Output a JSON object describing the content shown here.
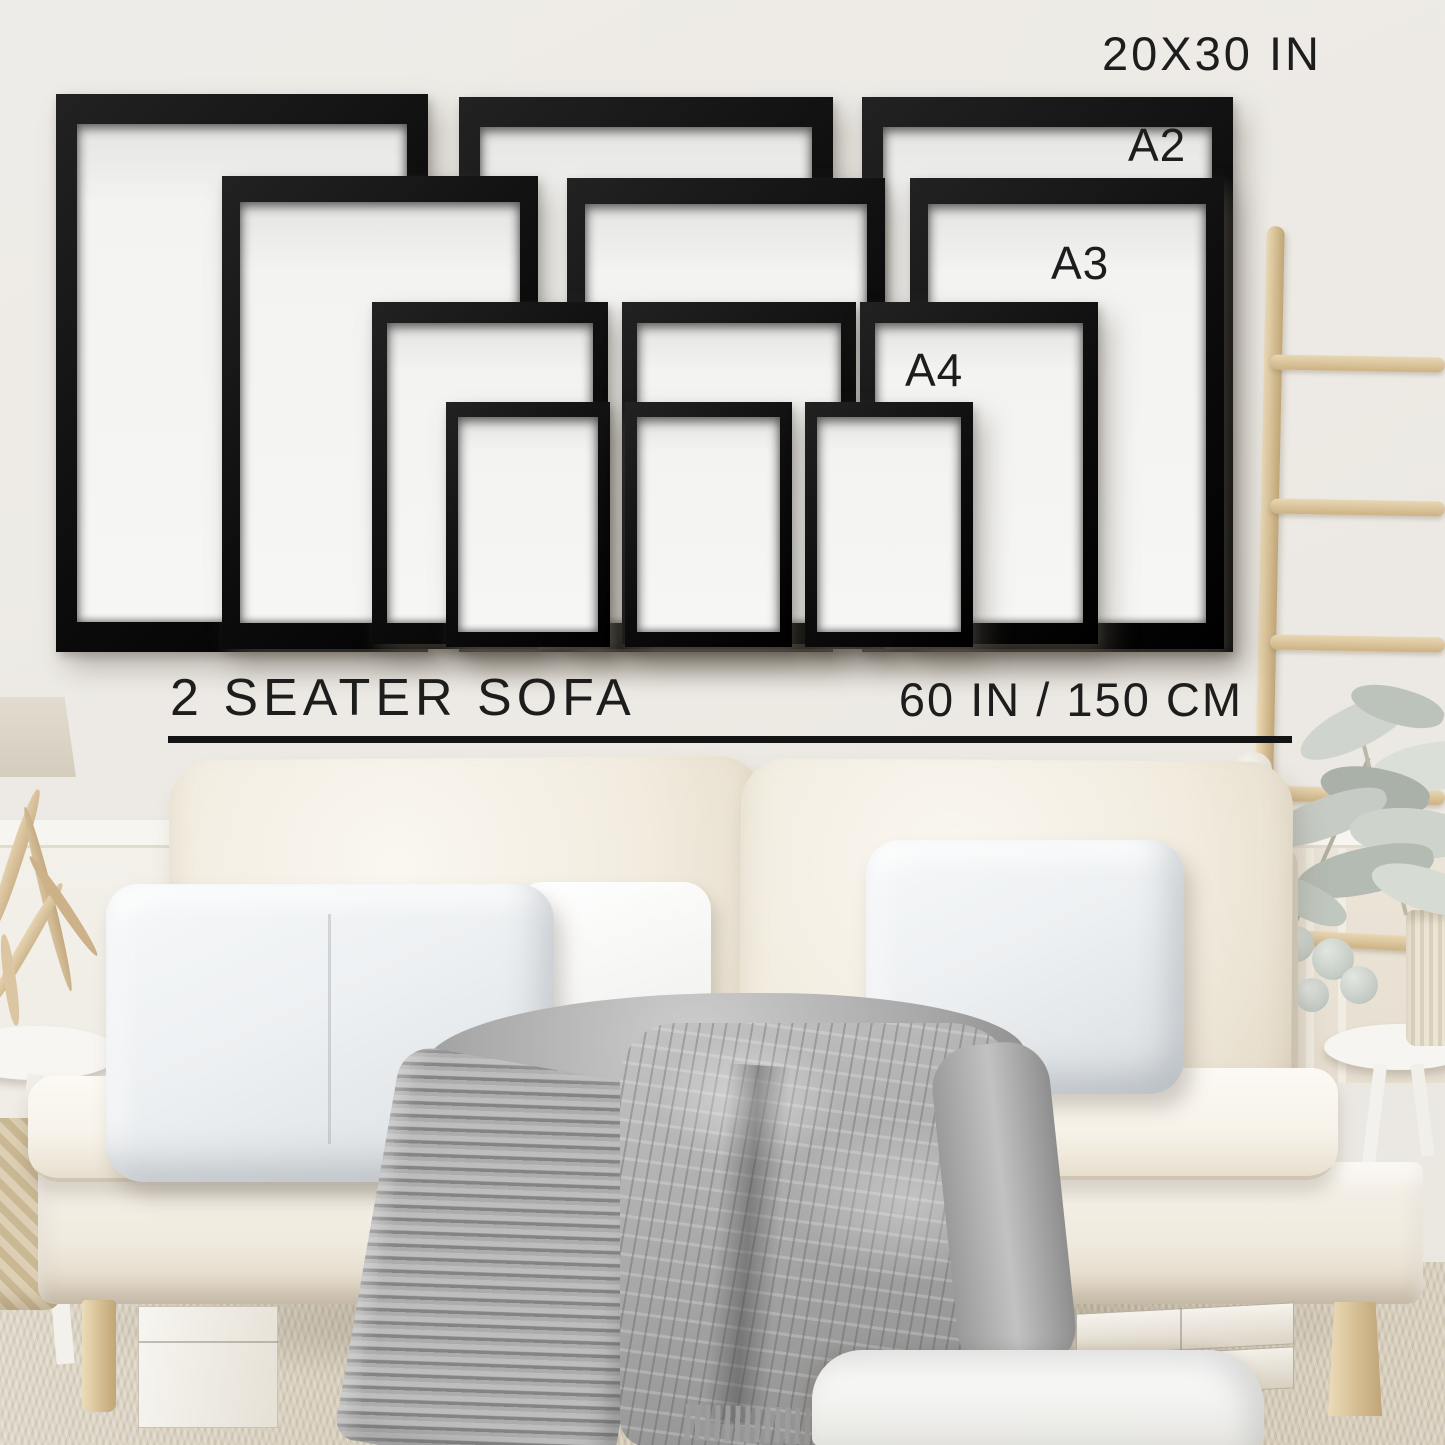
{
  "page_type": "poster-frame-size-guide-mockup",
  "size_chart": {
    "labels": {
      "largest": "20X30 IN",
      "a2": "A2",
      "a3": "A3",
      "a4": "A4"
    },
    "frame_rows": [
      {
        "size": "20X30 IN",
        "count": 3
      },
      {
        "size": "A2",
        "count": 3
      },
      {
        "size": "A3",
        "count": 3
      },
      {
        "size": "A4",
        "count": 3
      }
    ],
    "sofa_label": "2 SEATER SOFA",
    "sofa_width_label": "60 IN / 150 CM"
  },
  "colors": {
    "frame": "#141414",
    "text": "#1d1d1d",
    "wall": "#edeae5",
    "wood": "#d7c29c",
    "blanket": "#a8a8a8",
    "sofa": "#f6f2ea",
    "carpet": "#d3c8b4",
    "pillow": "#eef0f2"
  }
}
